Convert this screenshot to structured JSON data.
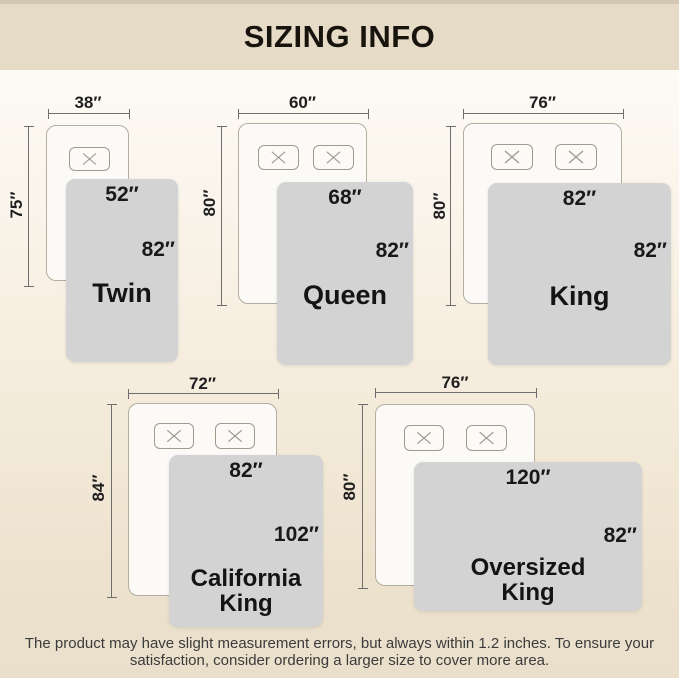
{
  "title": "SIZING INFO",
  "sizes": [
    {
      "name": "Twin",
      "mattress_width": "38″",
      "mattress_length": "75″",
      "blanket_width": "52″",
      "blanket_length": "82″",
      "pillow_count": 1
    },
    {
      "name": "Queen",
      "mattress_width": "60″",
      "mattress_length": "80″",
      "blanket_width": "68″",
      "blanket_length": "82″",
      "pillow_count": 2
    },
    {
      "name": "King",
      "mattress_width": "76″",
      "mattress_length": "80″",
      "blanket_width": "82″",
      "blanket_length": "82″",
      "pillow_count": 2
    },
    {
      "name": "California King",
      "mattress_width": "72″",
      "mattress_length": "84″",
      "blanket_width": "82″",
      "blanket_length": "102″",
      "pillow_count": 2
    },
    {
      "name": "Oversized King",
      "mattress_width": "76″",
      "mattress_length": "80″",
      "blanket_width": "120″",
      "blanket_length": "82″",
      "pillow_count": 2
    }
  ],
  "note": {
    "line1": "The product may have slight measurement errors, but always within 1.2 inches. To ensure your",
    "line2": "satisfaction, consider ordering a larger size to cover more area."
  },
  "colors": {
    "header_bg": "#e5dbc7",
    "header_strip": "#d3c7b2",
    "background_bottom": "#e9dfcb",
    "blanket": "#d3d3d3",
    "mattress": "#fbfaf7",
    "dimension_line": "#6e6e6e",
    "text": "#17130d"
  }
}
